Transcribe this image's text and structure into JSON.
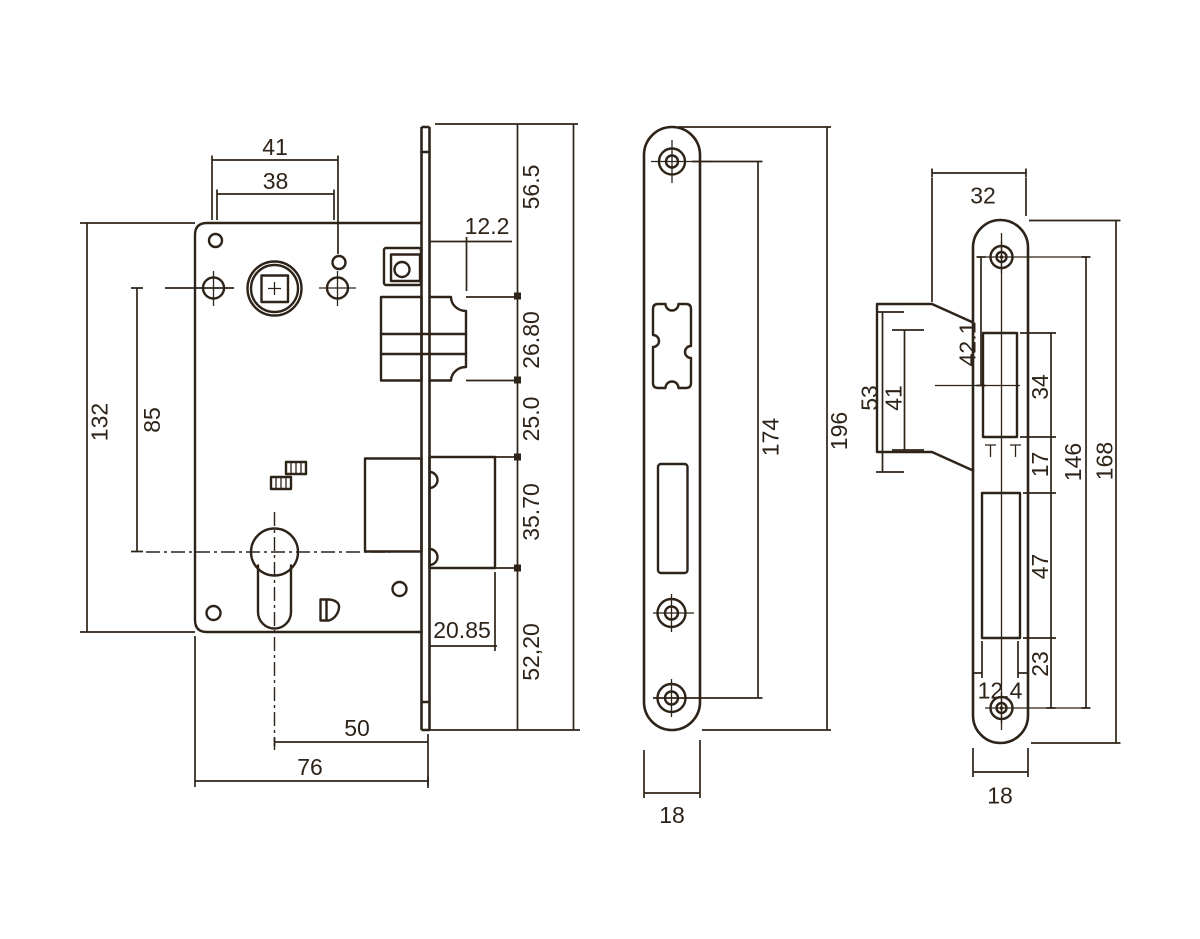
{
  "colors": {
    "line": "#2e2318",
    "background": "#ffffff"
  },
  "views": {
    "lock_case": {
      "dims": {
        "screw_spacing": "41",
        "hub_spacing": "38",
        "latch_projection": "12.2",
        "top_to_latch": "56.5",
        "latch_height": "26.80",
        "latch_to_deadbolt": "25.0",
        "deadbolt_height": "35.70",
        "deadbolt_to_bottom": "52,20",
        "deadbolt_projection": "20.85",
        "case_height": "132",
        "screw_to_cylinder": "85",
        "backset": "50",
        "case_depth": "76"
      }
    },
    "faceplate": {
      "dims": {
        "screw_spacing": "174",
        "length": "196",
        "width": "18"
      }
    },
    "strike_plate": {
      "dims": {
        "top_width": "32",
        "screw_to_latch_center": "42.1",
        "box_outer_height": "53",
        "box_inner_height": "41",
        "latch_cutout_height": "34",
        "cutout_gap": "17",
        "screw_spacing": "146",
        "length": "168",
        "deadbolt_cutout_height": "47",
        "cutout_to_screw": "23",
        "cutout_width": "12.4",
        "width": "18"
      }
    }
  }
}
